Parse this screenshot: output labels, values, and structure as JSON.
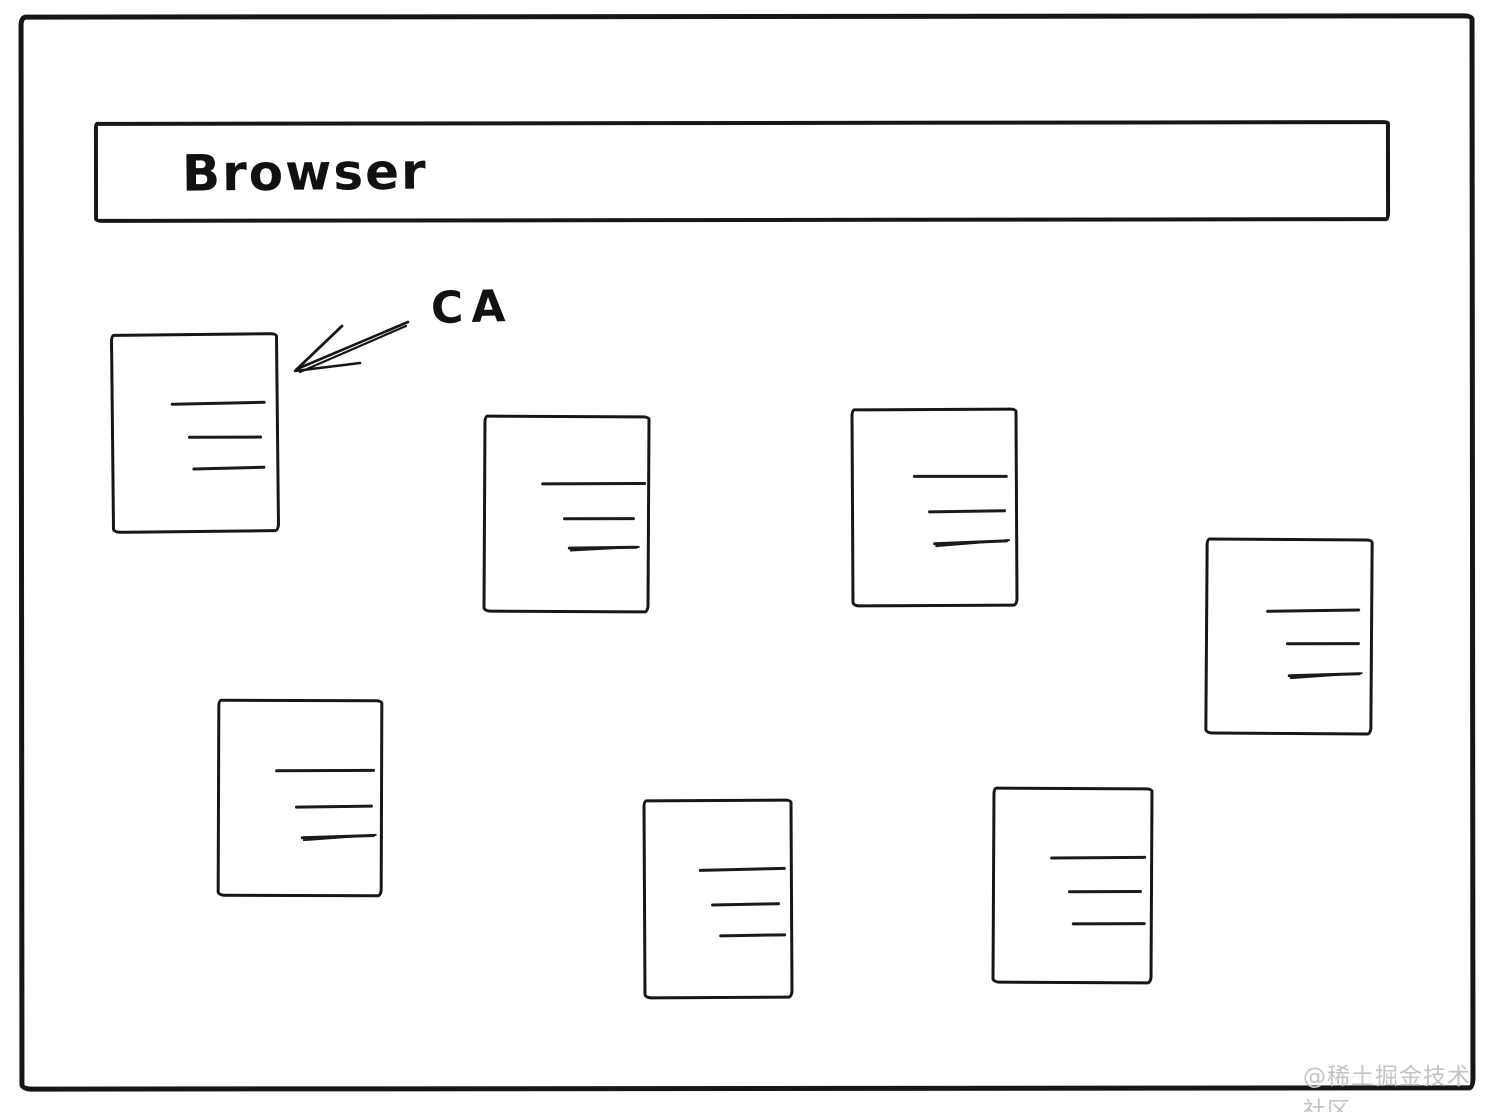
{
  "browser": {
    "label": "Browser"
  },
  "annotation": {
    "ca_label": "CA"
  },
  "certificates": {
    "count": 7,
    "lines_per_card": 3,
    "description": "blank certificate/document cards with placeholder text lines"
  },
  "watermark": {
    "text": "@稀土掘金技术社区"
  },
  "colors": {
    "ink": "#161616",
    "background": "#ffffff",
    "watermark": "#c3c3c3"
  }
}
